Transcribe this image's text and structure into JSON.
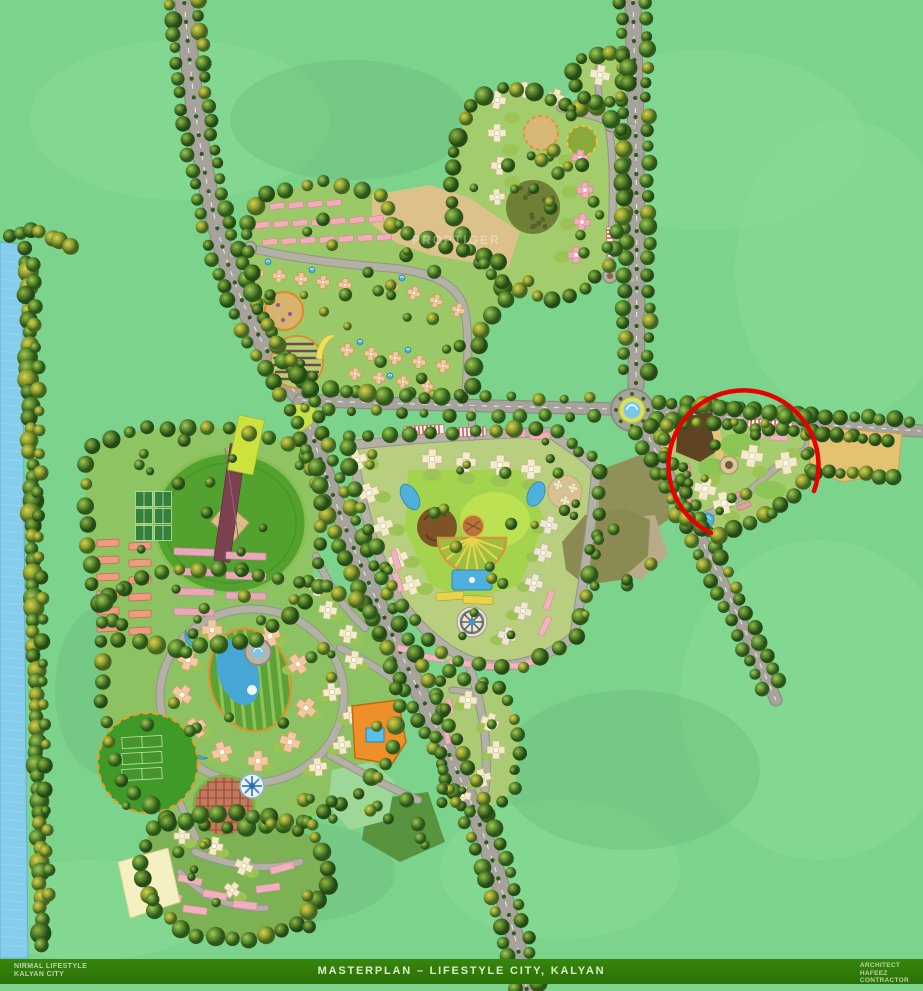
{
  "page": {
    "width": 923,
    "height": 991,
    "kind": "architectural masterplan rendering"
  },
  "footer": {
    "left_line1": "NIRMAL LIFESTYLE",
    "left_line2": "KALYAN CITY",
    "title": "MASTERPLAN – LIFESTYLE CITY, KALYAN",
    "right_line1": "ARCHITECT",
    "right_line2": "HAFEEZ",
    "right_line3": "CONTRACTOR"
  },
  "watermark": {
    "text": "PROPTIGER"
  },
  "map": {
    "annotation": {
      "shape": "red-circle",
      "purpose": "highlights the north-east residential tower cluster"
    },
    "palette": {
      "background": "#7cd38c",
      "water": "#85cdea",
      "road": "#a6a39c",
      "road_edge": "#8a8a80",
      "road_minor": "#b3b0a6",
      "lawn": "#9cc968",
      "lawn_bright": "#a9d64f",
      "pitch_green": "#53a12e",
      "sand": "#dcc18a",
      "building_cream": "#f2ecca",
      "building_pink": "#f2aeb8",
      "building_peach": "#f3c9a2",
      "building_salmon": "#f09a82",
      "building_orange": "#ef8f2a",
      "pool_blue": "#4fb0dc",
      "annotation_red": "#e80000",
      "footer_bar": "#2f7c06"
    },
    "features": [
      "river with tree bank",
      "tree-lined avenues",
      "divided highway",
      "central roundabout fountain",
      "cricket ground",
      "tennis courts",
      "athletics strip",
      "residential cross towers",
      "row houses",
      "retail strip",
      "swimming pool",
      "amphitheatre",
      "dome pavilion",
      "ferris-wheel plaza",
      "playground circles",
      "orchard garden",
      "clubhouse",
      "orange amenity block",
      "open land parcels",
      "red highlight circle annotation"
    ]
  }
}
